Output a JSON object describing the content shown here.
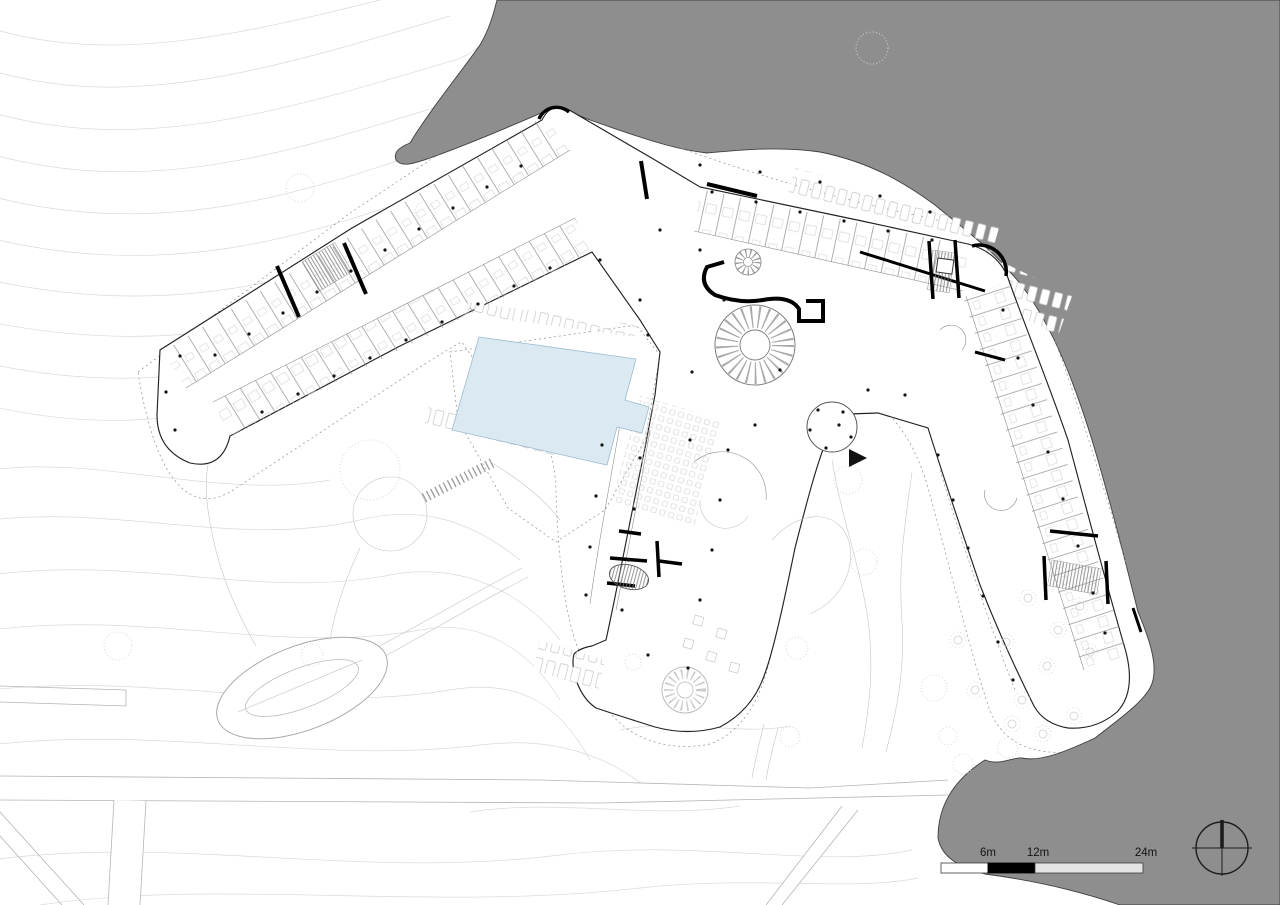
{
  "drawing": {
    "scale_bar": {
      "labels": [
        "6m",
        "12m",
        "24m"
      ],
      "segment_colors": [
        "#ffffff",
        "#000000",
        "#e4e4e4"
      ]
    },
    "compass_icon": "north-arrow-compass",
    "entrance_marker_icon": "entrance-arrow",
    "colors": {
      "water": "#8e8e8e",
      "land": "#ffffff",
      "pool_fill": "#dbe9f3",
      "pool_edge": "#9cbccf",
      "contour": "#d9d9d9",
      "line_dark": "#222222",
      "line_mid": "#8f8f8f",
      "line_light": "#c6c6c6",
      "accent": "#000000"
    }
  }
}
